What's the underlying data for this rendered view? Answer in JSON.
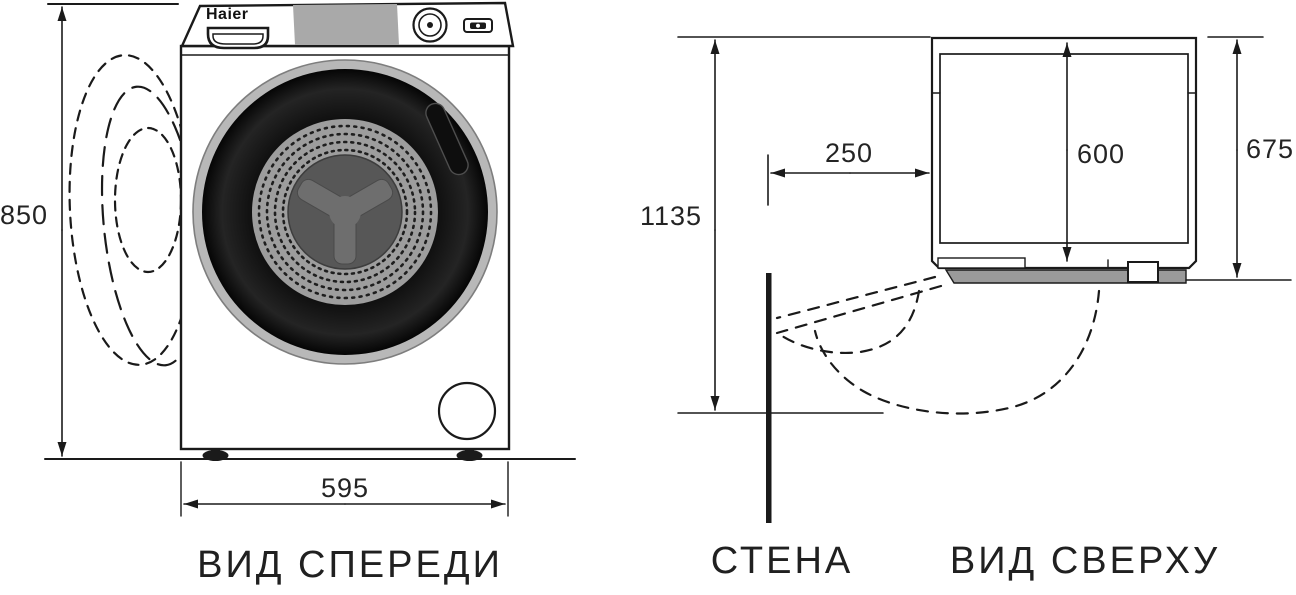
{
  "diagram": {
    "brand_logo": "Haier",
    "front_view": {
      "caption": "ВИД СПЕРЕДИ",
      "height_label": "850",
      "width_label": "595"
    },
    "wall": {
      "caption": "СТЕНА"
    },
    "top_view": {
      "caption": "ВИД СВЕРХУ",
      "open_depth_label": "1135",
      "wall_gap_label": "250",
      "body_depth_label": "600",
      "overall_depth_label": "675"
    },
    "colors": {
      "line": "#1a1a1a",
      "control_panel_gray": "#a9a9a9",
      "drum_gray": "#9d9d9d",
      "front_strip_gray": "#9a9a9a",
      "door_black": "#050505",
      "glass_gray": "#575757",
      "paddle_gray": "#6e6e6e"
    }
  }
}
